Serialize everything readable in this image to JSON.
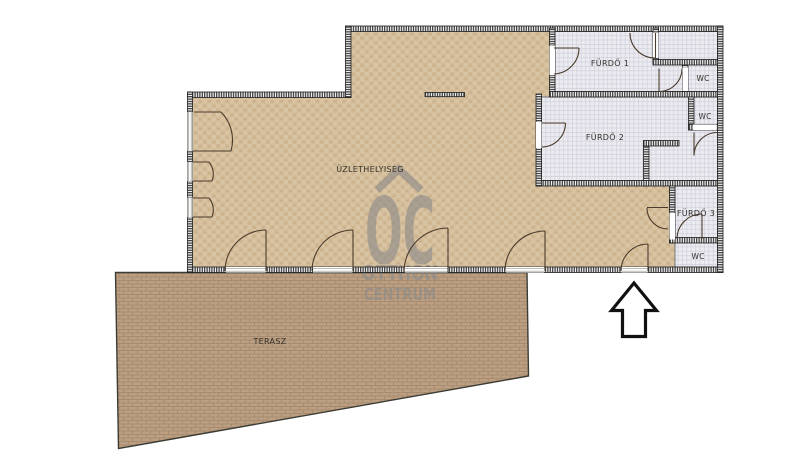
{
  "plan": {
    "rooms": [
      {
        "id": "uzlethelyiseg",
        "label": "ÜZLETHELYISÉG",
        "type": "shop-floor"
      },
      {
        "id": "furdo-1",
        "label": "FÜRDŐ 1",
        "type": "bathroom"
      },
      {
        "id": "wc-top",
        "label": "WC",
        "type": "toilet"
      },
      {
        "id": "wc-middle",
        "label": "WC",
        "type": "toilet"
      },
      {
        "id": "furdo-2",
        "label": "FÜRDŐ 2",
        "type": "bathroom"
      },
      {
        "id": "furdo-3",
        "label": "FÜRDŐ 3",
        "type": "bathroom"
      },
      {
        "id": "wc-bottom",
        "label": "WC",
        "type": "toilet"
      },
      {
        "id": "terasz",
        "label": "TERASZ",
        "type": "terrace"
      }
    ],
    "watermark": {
      "logo": "OC",
      "line1": "OTTHON",
      "line2": "CENTRUM"
    },
    "colors": {
      "floor_tan": "#d8c3a2",
      "bathroom_gray": "#ebebf0",
      "terrace_brown": "#bc9f82",
      "wall_dark": "#242424",
      "door_arc": "#4a3b2c",
      "watermark_gray": "#8a8a8a"
    }
  }
}
